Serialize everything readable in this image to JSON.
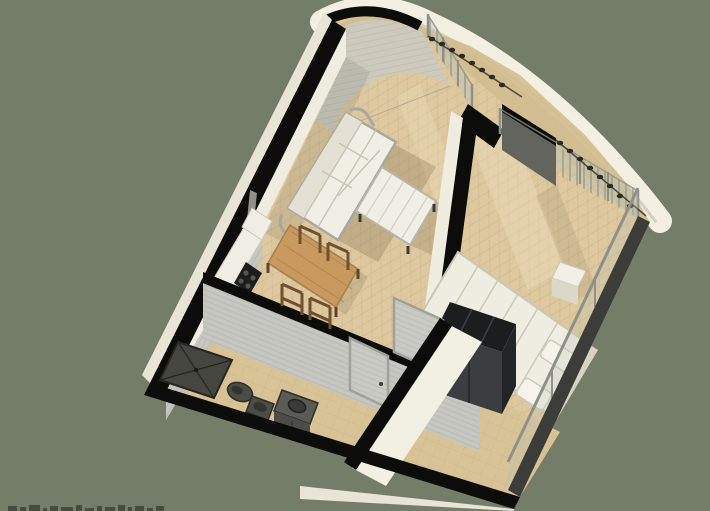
{
  "title": "isometric-apartment-floor-plan-render",
  "palette": {
    "bg": "#737d68",
    "wall_cut": "#0c0c0a",
    "wall_white": "#efece0",
    "wall_white_outer": "#e8e5d7",
    "wall_shade": "#d9d6c8",
    "curved_wall": "#cdcabd",
    "curved_wall_line": "#b4b1a4",
    "gray_tile_wall": "#c6c7c1",
    "gray_tile_wall_line": "#aeafa9",
    "wood_floor": "#ddc89f",
    "wood_floor_line": "#c2a679",
    "tile_floor": "#d8c397",
    "tile_line": "#bda678",
    "balcony_floor": "#d2bc8f",
    "parapet": "#f3f0e2",
    "parapet_shade": "#ccc8b9",
    "glass": "#b9c2b4",
    "mullion": "#8f9088",
    "curtain": "#a7a8a0",
    "curtain_dark": "#63645d",
    "railing_knob": "#2c2c27",
    "balustrade_base": "#3c3d38",
    "sofa_white": "#f1efe5",
    "sofa_shell": "#a8a8a0",
    "shadow": "#6e5f43",
    "table_wood": "#c89a60",
    "table_wood_line": "#a87e49",
    "chair_wood": "#6f5130",
    "counter_white": "#f0eee4",
    "cooktop": "#1d1d1b",
    "wardrobe_top": "#1c1d1f",
    "wardrobe_face": "#3b3d40",
    "wardrobe_side": "#232427",
    "bed_white": "#efede2",
    "bed_line": "#cbc6b4",
    "fixture_dark": "#4c4d48",
    "shower": "#45463f",
    "watermark": "#3e4538"
  },
  "scene": {
    "objects": {
      "render": "isometric cutaway render of a one-bedroom apartment",
      "living_room": "living room with wood parquet floor",
      "sofa": "white three-seat sofa",
      "ottoman": "white ottoman coffee table",
      "dining_table": "wooden dining table",
      "chairs": "four wooden dining chairs",
      "kitchen_counter": "kitchen counter with dark cooktop",
      "bathroom": "bathroom with gray tiled walls",
      "shower": "dark square shower tray",
      "toilet": "toilet",
      "bidet": "bidet",
      "vanity": "dark vanity cabinet with round basin",
      "hallway": "entry hallway with tiled floor",
      "doors": "gray interior doors",
      "bedroom": "bedroom with double bed",
      "bed": "double bed with white duvet and pillows",
      "nightstand": "white nightstand cube",
      "wardrobe": "dark wardrobe unit",
      "glazing": "floor-to-ceiling window wall with mullions and curtains",
      "parapet": "curved white balcony parapet",
      "railing": "balcony railing with dark baluster knobs",
      "balustrade": "glass balustrade on bedroom balcony edge",
      "curved_wall": "curved corner wall at top of plan"
    }
  },
  "watermark": {
    "description": "cut-off dark text fragment at bottom-left edge, only letter tops visible",
    "dash_pattern": [
      [
        9,
        5
      ],
      [
        6,
        4
      ],
      [
        11,
        6
      ],
      [
        4,
        3
      ],
      [
        8,
        5
      ],
      [
        12,
        4
      ],
      [
        6,
        6
      ],
      [
        9,
        3
      ],
      [
        5,
        5
      ],
      [
        10,
        4
      ],
      [
        7,
        6
      ],
      [
        4,
        4
      ],
      [
        9,
        5
      ],
      [
        6,
        3
      ],
      [
        8,
        5
      ]
    ],
    "gap": 3
  }
}
